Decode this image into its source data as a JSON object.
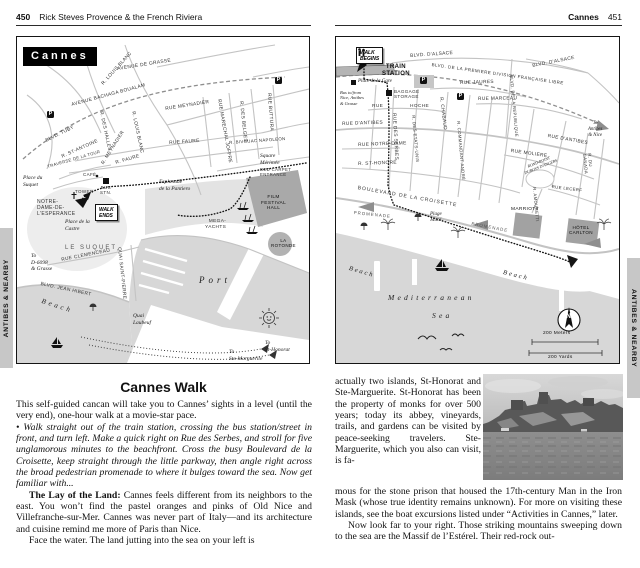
{
  "tabs": {
    "side_label": "ANTIBES & NEARBY"
  },
  "shared": {
    "parking": "P",
    "compass": "N"
  },
  "left_page": {
    "header": {
      "num": "450",
      "title": "Rick Steves Provence & the French Riviera"
    },
    "map_title": "Cannes",
    "lm": {
      "av_grasse": "AVENUE DE GRASSE",
      "louis_blanc_a": "R. LOUIS BLANC",
      "bachaga": "AVENUE BACHAGA BOUALAM",
      "tuby": "BLVD. TUBY",
      "halles": "R. DES HALLES",
      "louis_blanc_b": "R. LOUIS BLANC",
      "meynadier_a": "R. MEYNADIER",
      "meynadier_b": "RUE MEYNADIER",
      "faure_a": "R. FAURE",
      "faure_b": "RUE FAURE",
      "joffre": "RUE MARECHAL JOFFRE",
      "belges": "R. DES BELGES",
      "buttura": "RUE BUTTURA",
      "bivouac": "R. BIVOUAC NAPOLEON",
      "st_antoine": "R. ST-ANTOINE",
      "traverse": "TRAVERSE DE LA TOUR",
      "clemenceau": "RUE CLEMENCEAU",
      "quai_st_pierre": "QUAI SAINT-PIERRE",
      "jean_hibert": "BLVD. JEAN HIBERT",
      "quai_laubeuf": "Quai\nLaubeuf",
      "place_suquet": "Place du\nSuquet",
      "cafe": "CAFÉ",
      "tower": "TOWER",
      "bus_stn": "BUS\nSTN.",
      "notre_dame": "NOTRE-\nDAME-DE-\nL'ESPERANCE",
      "walk_ends": "WALK\nENDS",
      "place_castre": "Place de la\nCastre",
      "le_suquet": "LE SUQUET",
      "to_grasse": "To\nD-6098\n& Grasse",
      "beach": "Beach",
      "esplanade": "Esplanade\nde la Pantiero",
      "square_merimee": "Square\nMérimée",
      "red_carpet": "RED CARPET\nENTRANCE",
      "film_hall": "FILM\nFESTIVAL\nHALL",
      "mega_yachts": "MEGA-\nYACHTS",
      "la_rotonde": "LA\nROTONDE",
      "port": "Port",
      "to_st_honorat": "To\nSt-Honorat",
      "to_ste_marguerite": "To\nSte-Marguerite"
    },
    "article": {
      "heading": "Cannes Walk",
      "p1": "This self-guided cancan will take you to Cannes’ sights in a level (until the very end), one-hour walk at a movie-star pace.",
      "p2": "• Walk straight out of the train station, crossing the bus station/street in front, and turn left. Make a quick right on Rue des Serbes, and stroll for five unglamorous minutes to the beachfront. Cross the busy Boulevard de la Croisette, keep straight through the little parkway, then angle right across the broad pedestrian promenade to where it bulges toward the sea. Now get familiar with...",
      "p3_lead": "The Lay of the Land:",
      "p3_rest": " Cannes feels different from its neighbors to the east. You won’t find the pastel oranges and pinks of Old Nice and Villefranche-sur-Mer. Cannes was never part of Italy—and its architecture and cuisine remind me more of Paris than Nice.",
      "p4": "Face the water. The land jutting into the sea on your left is"
    }
  },
  "right_page": {
    "header": {
      "title": "Cannes",
      "num": "451"
    },
    "rm": {
      "walk_begins": "WALK\nBEGINS",
      "train_station": "TRAIN\nSTATION",
      "place_gare": "Place de la Gare",
      "baggage": "BAGGAGE\nSTORAGE",
      "bus_note": "Bus to/from\nNice, Antibes\n& Grasse",
      "alsace_a": "BLVD. D'ALSACE",
      "alsace_b": "BLVD. D'ALSACE",
      "premiere": "BLVD. DE LA PREMIERE DIVISION FRANÇAISE LIBRE",
      "to_antibes": "To\nAntibes\n& Nice",
      "jaures": "RUE JAURES",
      "marceau": "RUE MARCEAU",
      "republique": "BLVD. DE LA REPUBLIQUE",
      "hoche_a": "RUE",
      "hoche_b": "HOCHE",
      "antibes_a": "RUE D'ANTIBES",
      "antibes_b": "RUE D'ANTIBES",
      "notre_dame": "RUE NOTRE-DAME",
      "st_honore": "R. ST-HONORÉ",
      "serbes": "RUE DES SERBES",
      "etats_unis": "R. DES ETATS-UNIS",
      "chabaud": "R. CHABAUD",
      "cdt_andre": "R. COMMANDANT ANDRÉ",
      "moliere": "RUE MOLIERE",
      "lecerf": "RUE LECERF",
      "rond_point": "ROND-POINT\nDUBOYS D'ANGERS",
      "canada": "R. DU CANADA",
      "amouretti": "R. AMOURETTI",
      "croisette": "BOULEVARD DE LA CROISETTE",
      "promenade_a": "PROMENADE",
      "promenade_b": "PROMENADE",
      "plage_mace": "Plage\nMacé",
      "marriott": "MARRIOTT",
      "carlton": "HÔTEL\nCARLTON",
      "beach_a": "Beach",
      "beach_b": "Beach",
      "med": "Mediterranean",
      "sea": "Sea",
      "scale_m": "200 Meters",
      "scale_y": "200 Yards"
    },
    "article": {
      "col": "actually two islands, St-Honorat and Ste-Marguerite. St-Honorat has been the property of monks for over 500 years; today its abbey, vineyards, trails, and gardens can be visited by peace-seeking travelers. Ste-Marguerite, which you also can visit, is fa-",
      "full1": "mous for the stone prison that housed the 17th-century Man in the Iron Mask (whose true identity remains unknown). For more on visiting these islands, see the boat excursions listed under “Activities in Cannes,” later.",
      "full2": "Now look far to your right. Those striking mountains sweeping down to the sea are the Massif de l’Estérel. Their red-rock out-"
    }
  }
}
